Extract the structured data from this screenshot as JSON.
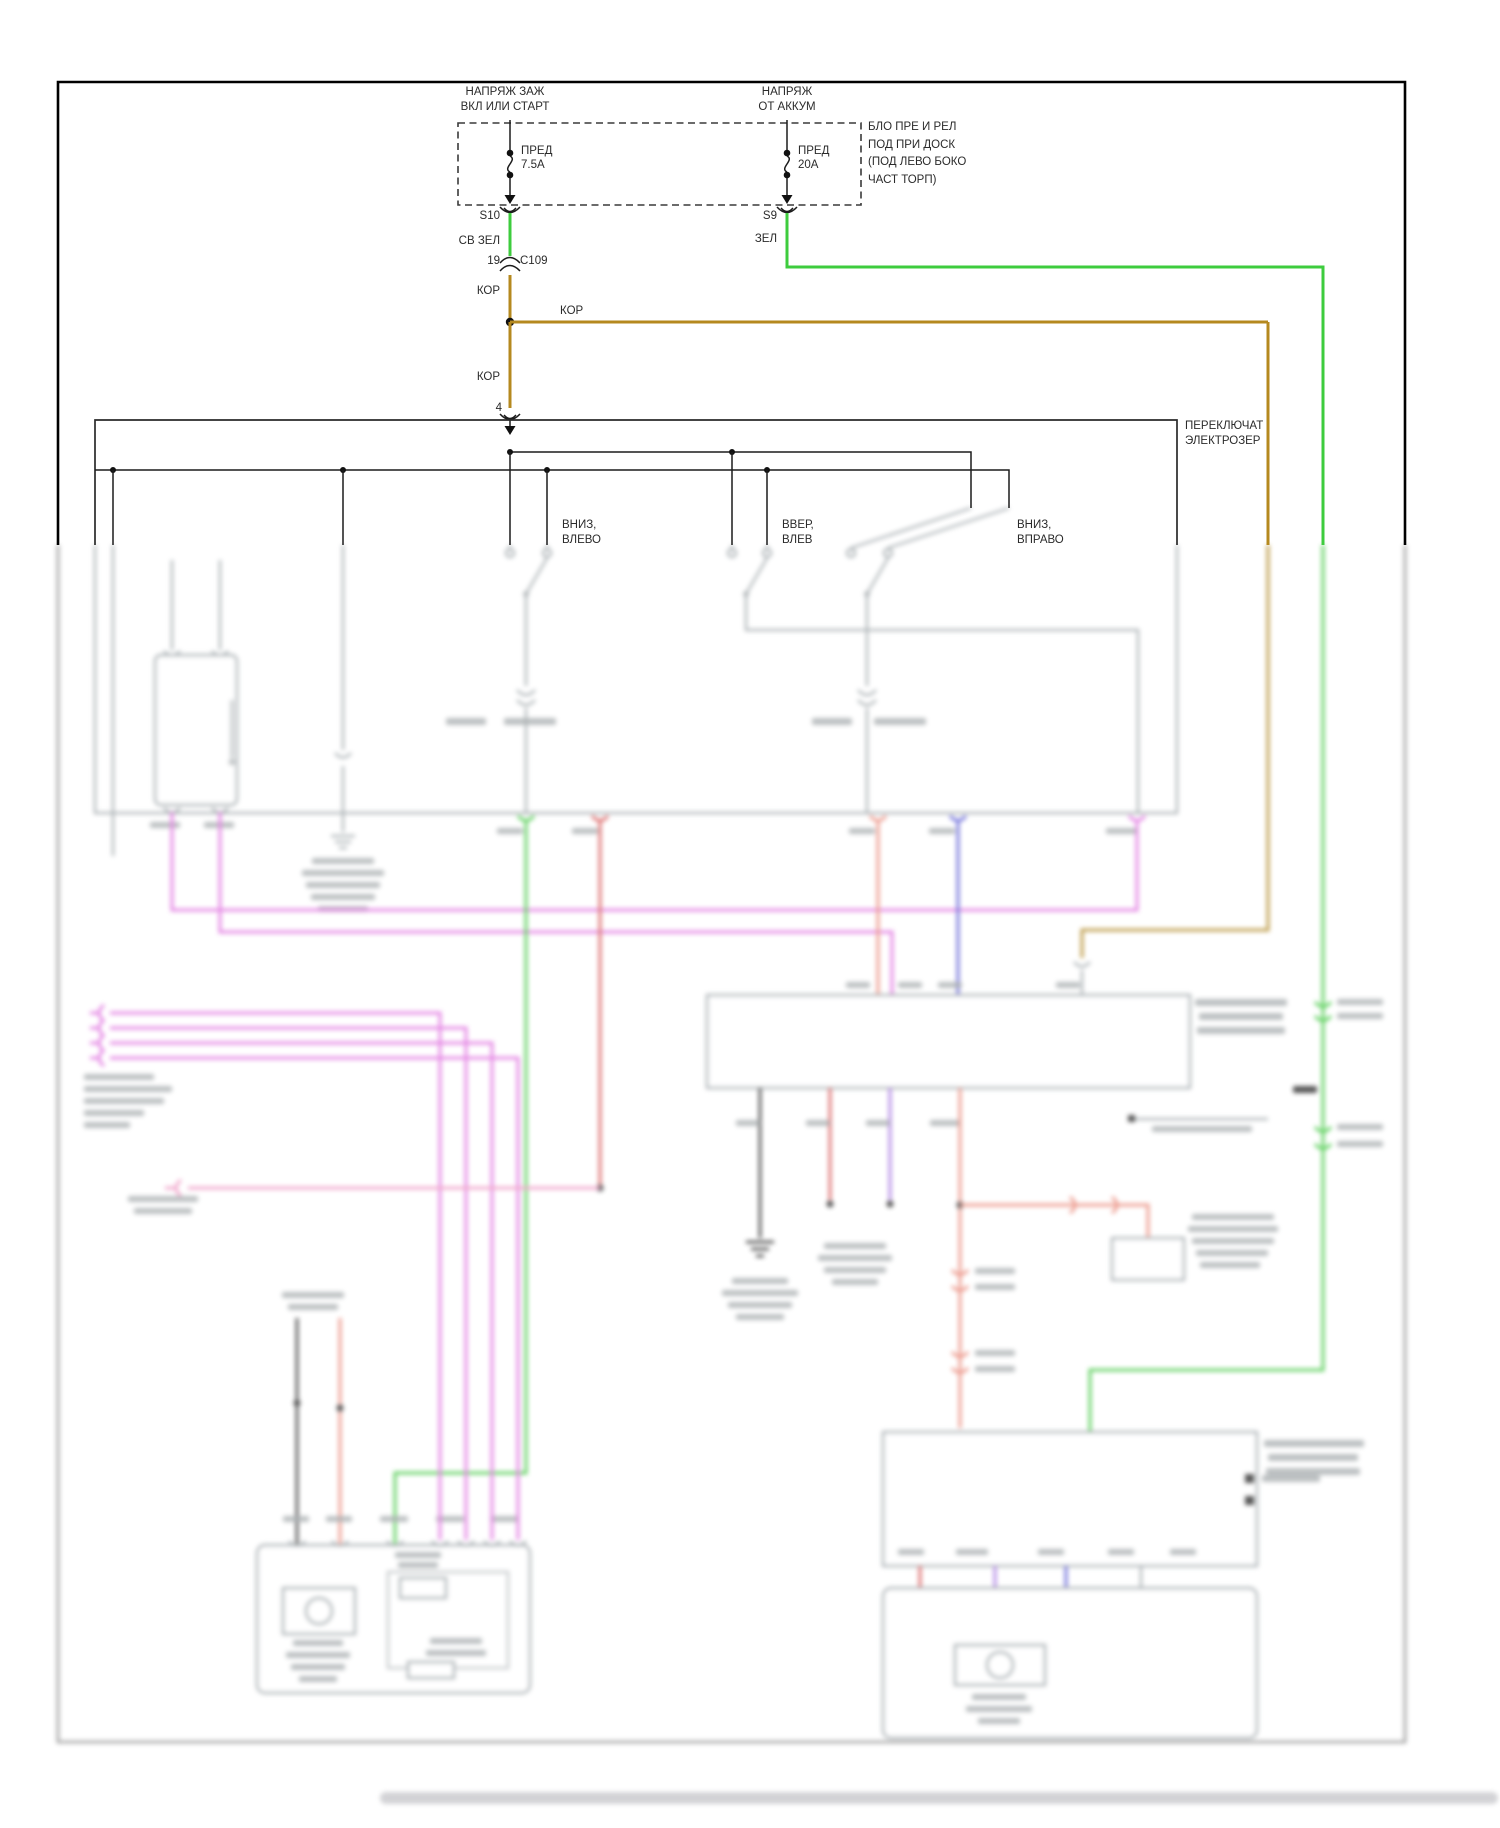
{
  "diagram": {
    "power_block": {
      "ign_label_1": "НАПРЯЖ ЗАЖ",
      "ign_label_2": "ВКЛ ИЛИ СТАРТ",
      "batt_label_1": "НАПРЯЖ",
      "batt_label_2": "ОТ АККУМ",
      "fuse_1_name": "ПРЕД",
      "fuse_1_rating": "7.5А",
      "fuse_2_name": "ПРЕД",
      "fuse_2_rating": "20А",
      "block_label_1": "БЛО ПРЕ И РЕЛ",
      "block_label_2": "ПОД ПРИ ДОСК",
      "block_label_3": "(ПОД ЛЕВО БОКО",
      "block_label_4": "ЧАСТ ТОРП)",
      "splice_left": "S10",
      "splice_right": "S9"
    },
    "wire_labels": {
      "light_green": "СВ ЗЕЛ",
      "green": "ЗЕЛ",
      "brown_a": "КОР",
      "brown_b": "КОР",
      "brown_c": "КОР",
      "pin_19": "19",
      "connector_c109": "C109",
      "pin_4": "4"
    },
    "switch": {
      "name_1": "ПЕРЕКЛЮЧАТ",
      "name_2": "ЭЛЕКТРОЗЕР",
      "pos_1a": "ВНИЗ,",
      "pos_1b": "ВЛЕВО",
      "pos_2a": "ВВЕР,",
      "pos_2b": "ВЛЕВ",
      "pos_3a": "ВНИЗ,",
      "pos_3b": "ВПРАВО"
    },
    "wire_colors": {
      "light_green": "#3ecc3e",
      "brown": "#b5891f",
      "magenta": "#e66de6",
      "pink": "#f494c4",
      "red": "#e05555",
      "salmon": "#f08878",
      "blue": "#5b5bde",
      "violet": "#a873e8",
      "black": "#333333",
      "gray": "#98a0a4"
    }
  }
}
